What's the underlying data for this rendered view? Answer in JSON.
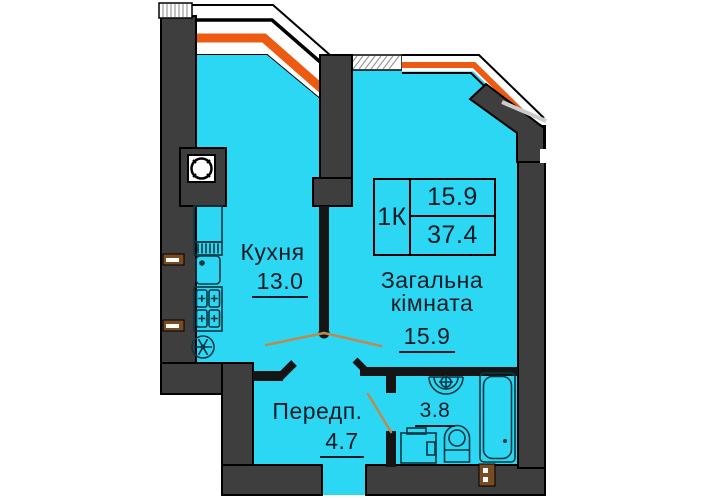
{
  "page_title": "Apartment floor plan",
  "colors": {
    "background": "#ffffff",
    "room_fill": "#2bd7f2",
    "wall": "#3e3e3e",
    "outline": "#000000",
    "window_accent": "#ed5a12",
    "door_swing": "#bd8a52",
    "anchor_brown": "#7a4a21",
    "hatch": "#9a9a9a"
  },
  "rooms": {
    "kitchen": {
      "label": "Кухня",
      "area": "13.0"
    },
    "living": {
      "label_line1": "Загальна",
      "label_line2": "кімната",
      "area": "15.9"
    },
    "hallway": {
      "label": "Передп.",
      "area": "4.7"
    },
    "bathroom": {
      "area": "3.8"
    }
  },
  "info_table": {
    "apartment_type": "1К",
    "living_area": "15.9",
    "total_area": "37.4"
  },
  "icons": [
    {
      "name": "ventilation-shaft-icon"
    },
    {
      "name": "kitchen-counter-icon"
    },
    {
      "name": "kitchen-sink-icon"
    },
    {
      "name": "stove-icon"
    },
    {
      "name": "extractor-fan-icon"
    },
    {
      "name": "washbasin-icon"
    },
    {
      "name": "washing-machine-icon"
    },
    {
      "name": "toilet-icon"
    },
    {
      "name": "bathtub-icon"
    },
    {
      "name": "wall-anchor-icon"
    },
    {
      "name": "pipe-riser-icon"
    },
    {
      "name": "window-band-icon"
    },
    {
      "name": "door-swing-icon"
    }
  ]
}
